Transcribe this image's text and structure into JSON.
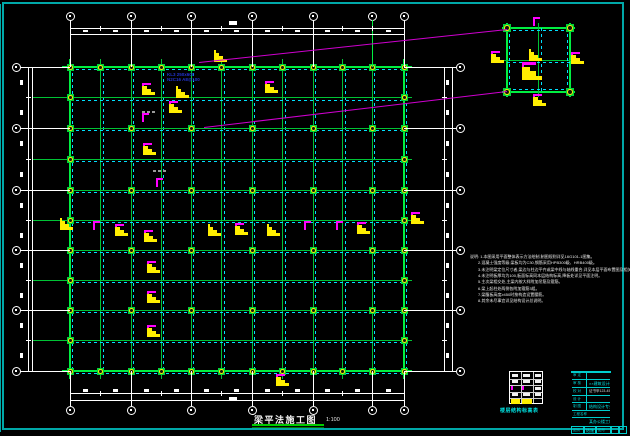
{
  "document": {
    "type": "cad-structural-drawing",
    "caption": {
      "title": "梁平法施工图",
      "scale": "1:100"
    },
    "beam_label": {
      "line1": "KL3 250x600",
      "line2": "N2C16 A8@100"
    }
  },
  "colors": {
    "bg": "#000000",
    "frame": "#00a8a8",
    "grid_green": "#00c335",
    "grid_bright": "#00ef41",
    "beam_cyan": "#00e0ff",
    "node_yellow": "#ffee00",
    "node_green": "#00d13a",
    "flag_magenta": "#ff00ff",
    "flag_yellow": "#ffee00",
    "dim_white": "#ffffff",
    "callout_magenta": "#cf00cf",
    "gray_dash": "#9a9a9a",
    "caption_underline": "#00cc00",
    "titleblock_line": "#00cccc",
    "titleblock_cyan": "#00e5e5",
    "floor_table_line": "#ffffff"
  },
  "plan": {
    "rect": {
      "x1": 70,
      "y1": 67,
      "x2": 404,
      "y2": 371
    },
    "x_axes": [
      70,
      100.5,
      131,
      161,
      191,
      221.5,
      252,
      282.5,
      313,
      342.5,
      372,
      404
    ],
    "x_major": [
      0,
      2,
      4,
      6,
      8,
      10,
      11
    ],
    "y_axes": [
      67,
      97.5,
      128,
      159,
      190,
      220,
      250,
      280,
      310,
      340,
      371
    ],
    "y_major": [
      0,
      2,
      4,
      6,
      8,
      10
    ],
    "green_stem_x": 372,
    "bubbles": {
      "top_y": 16,
      "bottom_y": 410,
      "left_x": 16,
      "right_x": 460
    },
    "dims": {
      "top": {
        "l1": 28,
        "l2": 34,
        "blob": 29.5
      },
      "bottom": {
        "l1": 393,
        "l2": 400,
        "blob": 389
      },
      "left": {
        "l1": 28,
        "l2": 32,
        "blob": 20
      },
      "right": {
        "l1": 444,
        "l2": 452,
        "blob": 446
      }
    },
    "total_dim_blobs": [
      [
        229,
        21
      ],
      [
        229,
        397
      ]
    ],
    "flags": [
      [
        142,
        83,
        "my"
      ],
      [
        176,
        86,
        "y"
      ],
      [
        169,
        101,
        "my"
      ],
      [
        142,
        113,
        "m"
      ],
      [
        143,
        143,
        "my"
      ],
      [
        156,
        178,
        "m"
      ],
      [
        115,
        224,
        "my"
      ],
      [
        144,
        230,
        "my"
      ],
      [
        147,
        261,
        "my"
      ],
      [
        147,
        291,
        "my"
      ],
      [
        147,
        325,
        "my"
      ],
      [
        60,
        218,
        "y"
      ],
      [
        93,
        221,
        "m"
      ],
      [
        208,
        224,
        "y"
      ],
      [
        235,
        223,
        "my"
      ],
      [
        267,
        224,
        "y"
      ],
      [
        304,
        221,
        "m"
      ],
      [
        336,
        221,
        "m"
      ],
      [
        357,
        222,
        "my"
      ],
      [
        411,
        212,
        "my"
      ],
      [
        214,
        50,
        "y"
      ],
      [
        265,
        81,
        "my"
      ],
      [
        276,
        374,
        "my"
      ]
    ],
    "gray_dashes": [
      [
        142,
        111
      ],
      [
        153,
        170
      ]
    ]
  },
  "detail": {
    "rect": {
      "x1": 507,
      "y1": 28,
      "x2": 570,
      "y2": 92
    },
    "flags": [
      [
        533,
        17,
        "m"
      ],
      [
        529,
        49,
        "y"
      ],
      [
        491,
        51,
        "my"
      ],
      [
        522,
        62,
        "Y"
      ],
      [
        571,
        52,
        "my"
      ],
      [
        533,
        94,
        "my"
      ]
    ]
  },
  "callouts": [
    [
      199,
      62,
      507,
      29
    ],
    [
      204,
      127,
      507,
      91
    ]
  ],
  "notes": {
    "x": 470,
    "y": 254,
    "lines": [
      "说明: 1.本图采用平面整体表示方法绘制,制图规则详见16G101-1图集。",
      "2.混凝土强度等级:梁板均为C30,钢筋采用HPB300级、HRB400级。",
      "3.未注明梁定位尺寸者,梁边与柱边平齐或梁中线与轴线重合,详见本层平面布置图及相关大样。",
      "4.未注明板厚均为100,板面标高同本层结构标高,降板处详见平面注明。",
      "5.主次梁相交处,主梁内按大样附加吊筋及箍筋。",
      "6.梁上起柱处两侧各附加箍筋3组。",
      "7.梁腹板高度≥450时按构造设置腰筋。",
      "8.其余未尽事宜详见结构设计总说明。"
    ]
  },
  "title_block": {
    "x": 571,
    "y": 371,
    "w": 40,
    "h": 55,
    "rows": [
      {
        "h": 8,
        "label": "审 定",
        "value": "",
        "vc": ""
      },
      {
        "h": 8,
        "label": "审 核",
        "value": "××建筑设计院",
        "vc": "cyan"
      },
      {
        "h": 8,
        "label": "校 对",
        "value": "证书甲123-456",
        "vc": "white"
      },
      {
        "h": 7,
        "label": "设 计",
        "value": "",
        "vc": ""
      },
      {
        "h": 8,
        "label": "制 图",
        "value": "结构设计专业",
        "vc": "cyan"
      },
      {
        "h": 7,
        "label": "工程名称",
        "value": "",
        "vc": "",
        "wide": true
      },
      {
        "h": 9,
        "label": "",
        "value": "某办公楼工程",
        "vc": "cyan",
        "wide": true
      }
    ],
    "bottom_cells": [
      "图别",
      "结施",
      "图号",
      "",
      ""
    ]
  },
  "floor_table": {
    "x": 509,
    "y": 371,
    "w": 34,
    "h": 33,
    "rows": 5,
    "cols": 3,
    "filled_white": [
      [
        0,
        0
      ],
      [
        0,
        1
      ],
      [
        0,
        2
      ],
      [
        1,
        0
      ],
      [
        1,
        1
      ],
      [
        1,
        2
      ],
      [
        2,
        2
      ],
      [
        3,
        0
      ],
      [
        3,
        1
      ],
      [
        3,
        2
      ]
    ],
    "magenta_marks": [
      [
        2,
        0
      ],
      [
        2,
        1
      ]
    ],
    "yellow_marks": [
      [
        4,
        0
      ],
      [
        4,
        1
      ]
    ],
    "caption": "楼层结构标高表"
  }
}
